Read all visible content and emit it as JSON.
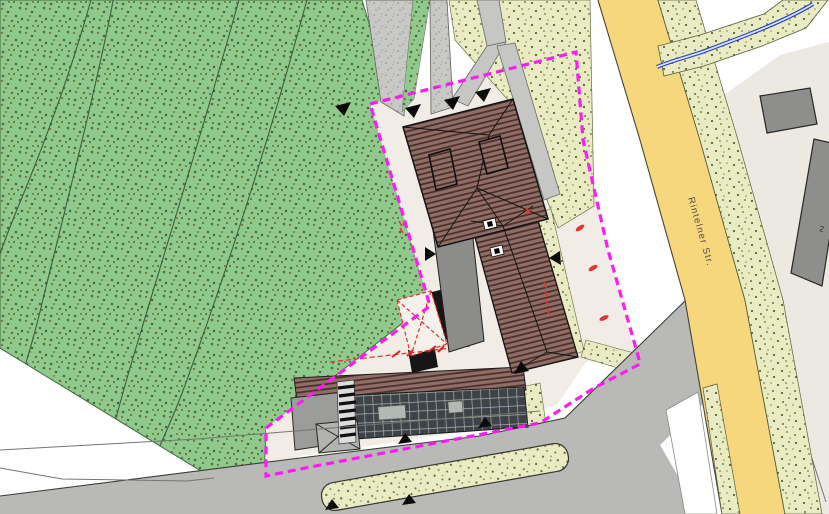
{
  "labels": {
    "street_name": "Rintelner Str.",
    "building_number": "2"
  },
  "colors": {
    "boundary_magenta": "#ff1cf2",
    "street_yellow": "#f7d77c",
    "vegetation_green": "#8fc98c",
    "verge_beige": "#e9ebc3",
    "roof_brown": "#8e6f67",
    "roof_hatch_line": "#4e2b28",
    "flat_roof_gray": "#8c8c8a",
    "asphalt_gray": "#b9b9b7",
    "neighbor_area_beige": "#ece8e2",
    "water_blue": "#2238c8",
    "marking_red": "#e0302c"
  }
}
